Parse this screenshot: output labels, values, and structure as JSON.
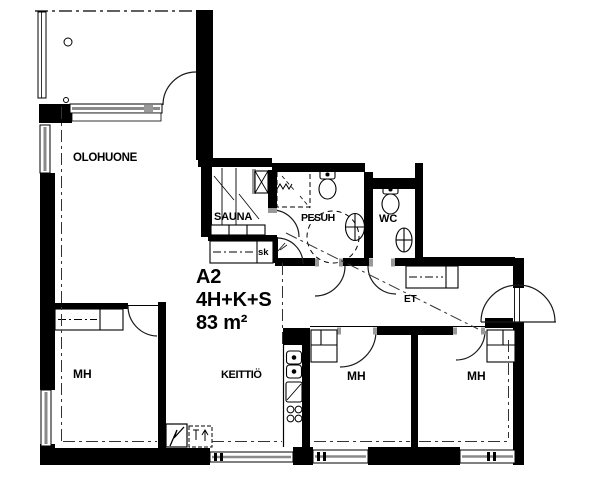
{
  "title": {
    "apartment_id": "A2",
    "layout_code": "4H+K+S",
    "area": "83 m²"
  },
  "rooms": {
    "living_room": "OLOHUONE",
    "sauna": "SAUNA",
    "washroom": "PESUH",
    "toilet": "WC",
    "closet_abbr": "sk",
    "bedroom_left": "MH",
    "kitchen": "KEITTIÖ",
    "bedroom_middle": "MH",
    "bedroom_right": "MH",
    "entry_hall": "ET"
  },
  "colors": {
    "wall": "#000000",
    "door_frame": "#999999",
    "window_mid": "#8a8a8a",
    "background": "#ffffff"
  }
}
